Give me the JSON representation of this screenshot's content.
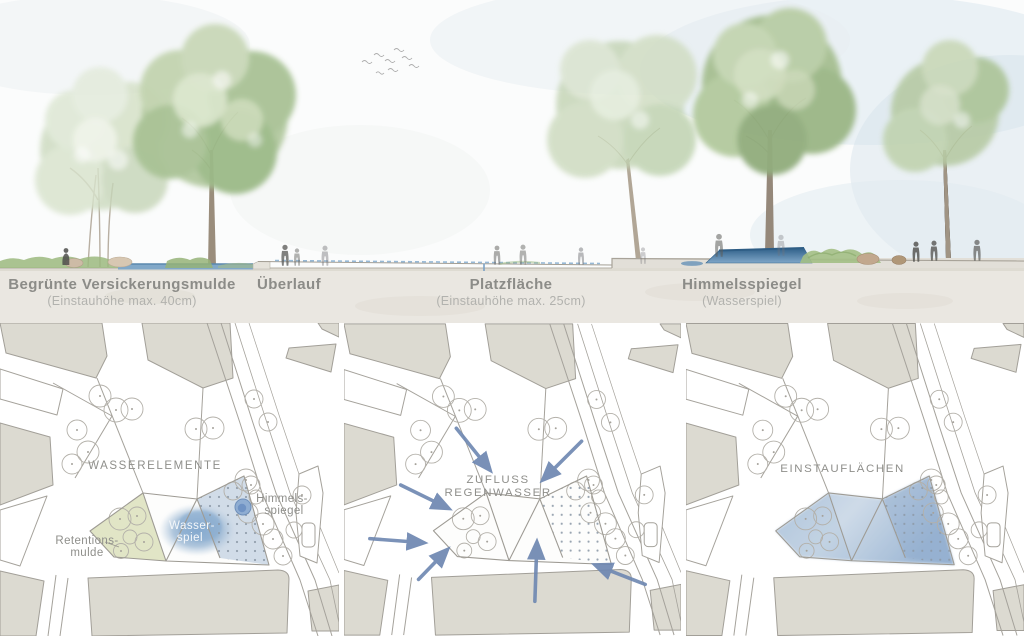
{
  "section_view": {
    "labels": [
      {
        "title": "Begrünte Versickerungsmulde",
        "subtitle": "(Einstauhöhe max. 40cm)"
      },
      {
        "title": "Überlauf",
        "subtitle": ""
      },
      {
        "title": "Platzfläche",
        "subtitle": "(Einstauhöhe max. 25cm)"
      },
      {
        "title": "Himmelsspiegel",
        "subtitle": "(Wasserspiel)"
      }
    ]
  },
  "plans": {
    "wasserelemente": {
      "heading": "WASSERELEMENTE",
      "retention_label": [
        "Retentions-",
        "mulde"
      ],
      "wasserspiel_label": [
        "Wasser-",
        "spiel"
      ],
      "himmelsspiegel_label": [
        "Himmels-",
        "spiegel"
      ]
    },
    "zufluss": {
      "heading": [
        "ZUFLUSS",
        "REGENWASSER"
      ]
    },
    "einstau": {
      "heading": "EINSTAUFLÄCHEN"
    }
  },
  "colors": {
    "water_blue": "#8fb0d0",
    "retention_green": "#dfe4c3",
    "arrow_blue": "#7089b2",
    "basin_blue": "#3f6f98",
    "building_beige": "#dcdad1",
    "label_gray": "#8c8c88"
  }
}
